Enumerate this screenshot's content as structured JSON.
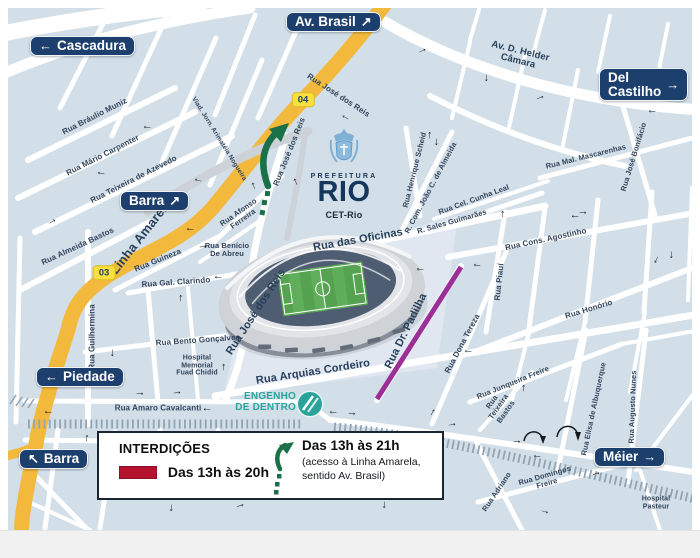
{
  "map": {
    "colors": {
      "map_bg": "#d2dfe8",
      "road_white": "#ffffff",
      "road_yellow": "#f2b93d",
      "viaduct_gray": "#ccd2d8",
      "sign_navy": "#1d3f6e",
      "interdiction_red": "#b5122d",
      "interdiction_purple": "#9b2f97",
      "rail_gray": "#92a3b1",
      "station_teal": "#2aa39a",
      "arrow_green": "#1a7048",
      "label_navy": "#32445c"
    },
    "logo": {
      "prefeitura": "PREFEITURA",
      "name": "RIO",
      "dept": "CET-Rio"
    },
    "station": {
      "line1": "ENGENHO",
      "line2": "DE DENTRO"
    },
    "legend": {
      "title": "INTERDIÇÕES",
      "items": [
        {
          "type": "red-line",
          "label": "Das 13h às 20h"
        },
        {
          "type": "green-arrow",
          "label": "Das 13h às 21h",
          "sub1": "(acesso à Linha Amarela,",
          "sub2": "sentido Av. Brasil)"
        }
      ]
    },
    "region_signs": [
      {
        "id": "cascadura",
        "label": "Cascadura",
        "arrow": "←",
        "side": "left",
        "x": 30,
        "y": 36,
        "wrap": false
      },
      {
        "id": "av-brasil",
        "label": "Av. Brasil",
        "arrow": "↗",
        "side": "right",
        "x": 286,
        "y": 12,
        "wrap": false
      },
      {
        "id": "del-castilho",
        "label": "Del Castilho",
        "arrow": "→",
        "side": "right",
        "x": 599,
        "y": 68,
        "wrap": true
      },
      {
        "id": "barra-north",
        "label": "Barra",
        "arrow": "↗",
        "side": "right",
        "x": 120,
        "y": 191,
        "wrap": false
      },
      {
        "id": "piedade",
        "label": "Piedade",
        "arrow": "←",
        "side": "left",
        "x": 36,
        "y": 367,
        "wrap": false
      },
      {
        "id": "barra-south",
        "label": "Barra",
        "arrow": "↖",
        "side": "left",
        "x": 19,
        "y": 449,
        "wrap": false
      },
      {
        "id": "meier",
        "label": "Méier",
        "arrow": "→",
        "side": "right",
        "x": 594,
        "y": 447,
        "wrap": false
      }
    ],
    "route_badges": [
      {
        "label": "04",
        "x": 303,
        "y": 100
      },
      {
        "label": "03",
        "x": 104,
        "y": 273
      }
    ],
    "street_labels": [
      {
        "t": "Rua Bráulio Muniz",
        "x": 95,
        "y": 117,
        "r": -27,
        "s": 8
      },
      {
        "t": "Rua Mário Carpenter",
        "x": 103,
        "y": 156,
        "r": -27,
        "s": 8
      },
      {
        "t": "Rua Teixeira de Azevedo",
        "x": 134,
        "y": 180,
        "r": -27,
        "s": 8
      },
      {
        "t": "Rua Almeida Bastos",
        "x": 78,
        "y": 247,
        "r": -25,
        "s": 8
      },
      {
        "t": "Rua Guilhermina",
        "x": 93,
        "y": 337,
        "r": -90,
        "s": 8
      },
      {
        "t": "Linha Amarela",
        "x": 141,
        "y": 237,
        "r": -52,
        "s": 13,
        "w": 1
      },
      {
        "t": "Rua Guineza",
        "x": 158,
        "y": 261,
        "r": -22,
        "s": 8
      },
      {
        "t": "Rua Gal. Clarindo",
        "x": 176,
        "y": 283,
        "r": -4,
        "s": 8
      },
      {
        "t": "Rua Bento Gonçalves",
        "x": 198,
        "y": 341,
        "r": -4,
        "s": 8
      },
      {
        "t": "Hospital Memorial Fuad Chidid",
        "x": 197,
        "y": 366,
        "r": 0,
        "s": 7,
        "mw": 46
      },
      {
        "t": "Rua Amaro Cavalcanti",
        "x": 158,
        "y": 409,
        "r": 0,
        "s": 8
      },
      {
        "t": "Rua Afonso Ferreira",
        "x": 241,
        "y": 216,
        "r": -35,
        "s": 7.5,
        "mw": 52
      },
      {
        "t": "Rua Benício De Abreu",
        "x": 227,
        "y": 250,
        "r": 0,
        "s": 7.5,
        "mw": 55
      },
      {
        "t": "Rua José dos Reis",
        "x": 338,
        "y": 96,
        "r": 33,
        "s": 8
      },
      {
        "t": "Rua José dos Reis",
        "x": 290,
        "y": 152,
        "r": -68,
        "s": 8
      },
      {
        "t": "Rua José dos Reis",
        "x": 256,
        "y": 312,
        "r": -57,
        "s": 11,
        "w": 1
      },
      {
        "t": "Viad. Jorn. Arimatéia Nogueira",
        "x": 219,
        "y": 139,
        "r": 58,
        "s": 6.5
      },
      {
        "t": "Rua das Oficinas",
        "x": 358,
        "y": 240,
        "r": -10,
        "s": 11,
        "w": 1
      },
      {
        "t": "Rua Arquias Cordeiro",
        "x": 313,
        "y": 372,
        "r": -9,
        "s": 11,
        "w": 1
      },
      {
        "t": "Rua Dr. Padilha",
        "x": 406,
        "y": 331,
        "r": -64,
        "s": 11,
        "w": 1
      },
      {
        "t": "Rua Dona Tereza",
        "x": 463,
        "y": 344,
        "r": -62,
        "s": 8
      },
      {
        "t": "Rua Piauí",
        "x": 500,
        "y": 282,
        "r": -84,
        "s": 8
      },
      {
        "t": "R. Sales Guimarães",
        "x": 452,
        "y": 222,
        "r": -16,
        "s": 7.5
      },
      {
        "t": "Rua Cel. Cunha Leal",
        "x": 474,
        "y": 200,
        "r": -20,
        "s": 7.5
      },
      {
        "t": "R. Com. João C. de Almeida",
        "x": 431,
        "y": 188,
        "r": -62,
        "s": 7.5
      },
      {
        "t": "Rua Henrique Scheid",
        "x": 415,
        "y": 170,
        "r": -76,
        "s": 7.5
      },
      {
        "t": "Av. D. Helder Câmara",
        "x": 519,
        "y": 57,
        "r": 14,
        "s": 9.5,
        "mw": 82,
        "w": 1
      },
      {
        "t": "Rua Mal. Mascarenhas",
        "x": 586,
        "y": 157,
        "r": -14,
        "s": 7.5
      },
      {
        "t": "Rua José Bonifácio",
        "x": 634,
        "y": 157,
        "r": -73,
        "s": 7.5
      },
      {
        "t": "Rua Cons. Agostinho",
        "x": 546,
        "y": 240,
        "r": -12,
        "s": 8
      },
      {
        "t": "Rua Honório",
        "x": 589,
        "y": 310,
        "r": -17,
        "s": 8
      },
      {
        "t": "Rua Junqueira Freire",
        "x": 513,
        "y": 383,
        "r": -22,
        "s": 7.5
      },
      {
        "t": "Rua Teixeira Bastos",
        "x": 499,
        "y": 407,
        "r": -55,
        "s": 7.5,
        "mw": 40
      },
      {
        "t": "Rua Elisa de Albuquerque",
        "x": 594,
        "y": 409,
        "r": -78,
        "s": 7.5
      },
      {
        "t": "Rua Augusto Nunes",
        "x": 633,
        "y": 407,
        "r": -88,
        "s": 7.5
      },
      {
        "t": "Rua Domingos Freire",
        "x": 546,
        "y": 480,
        "r": -16,
        "s": 7.5,
        "mw": 72
      },
      {
        "t": "Rua Adriano",
        "x": 497,
        "y": 492,
        "r": -56,
        "s": 7.5
      },
      {
        "t": "Hospital Pasteur",
        "x": 656,
        "y": 503,
        "r": 0,
        "s": 7,
        "mw": 44
      }
    ],
    "oneway_arrows": [
      {
        "x": 147,
        "y": 128,
        "r": 185
      },
      {
        "x": 101,
        "y": 174,
        "r": 190
      },
      {
        "x": 198,
        "y": 181,
        "r": 195
      },
      {
        "x": 253,
        "y": 186,
        "r": 250
      },
      {
        "x": 295,
        "y": 182,
        "r": 245
      },
      {
        "x": 345,
        "y": 118,
        "r": 210
      },
      {
        "x": 429,
        "y": 135,
        "r": 270
      },
      {
        "x": 437,
        "y": 142,
        "r": 90
      },
      {
        "x": 422,
        "y": 50,
        "r": 335
      },
      {
        "x": 487,
        "y": 78,
        "r": 90
      },
      {
        "x": 540,
        "y": 97,
        "r": 340
      },
      {
        "x": 652,
        "y": 112,
        "r": 185
      },
      {
        "x": 583,
        "y": 212,
        "r": 0
      },
      {
        "x": 575,
        "y": 217,
        "r": 180
      },
      {
        "x": 502,
        "y": 214,
        "r": 270
      },
      {
        "x": 477,
        "y": 266,
        "r": 190
      },
      {
        "x": 657,
        "y": 260,
        "r": 115
      },
      {
        "x": 672,
        "y": 255,
        "r": 90
      },
      {
        "x": 52,
        "y": 221,
        "r": 330
      },
      {
        "x": 190,
        "y": 230,
        "r": 185
      },
      {
        "x": 203,
        "y": 246,
        "r": 355
      },
      {
        "x": 218,
        "y": 278,
        "r": 185
      },
      {
        "x": 180,
        "y": 298,
        "r": 270
      },
      {
        "x": 113,
        "y": 353,
        "r": 90
      },
      {
        "x": 223,
        "y": 367,
        "r": 270
      },
      {
        "x": 140,
        "y": 393,
        "r": 0
      },
      {
        "x": 177,
        "y": 392,
        "r": 355
      },
      {
        "x": 48,
        "y": 413,
        "r": 185
      },
      {
        "x": 207,
        "y": 410,
        "r": 182
      },
      {
        "x": 86,
        "y": 438,
        "r": 280
      },
      {
        "x": 172,
        "y": 508,
        "r": 95
      },
      {
        "x": 240,
        "y": 505,
        "r": 345
      },
      {
        "x": 333,
        "y": 413,
        "r": 185
      },
      {
        "x": 352,
        "y": 413,
        "r": 5
      },
      {
        "x": 432,
        "y": 412,
        "r": 300
      },
      {
        "x": 452,
        "y": 424,
        "r": 350
      },
      {
        "x": 523,
        "y": 388,
        "r": 270
      },
      {
        "x": 517,
        "y": 441,
        "r": 0
      },
      {
        "x": 537,
        "y": 457,
        "r": 185
      },
      {
        "x": 596,
        "y": 473,
        "r": 345
      },
      {
        "x": 385,
        "y": 505,
        "r": 95
      },
      {
        "x": 545,
        "y": 511,
        "r": 15
      },
      {
        "x": 468,
        "y": 352,
        "r": 185
      },
      {
        "x": 420,
        "y": 270,
        "r": 185
      }
    ]
  }
}
